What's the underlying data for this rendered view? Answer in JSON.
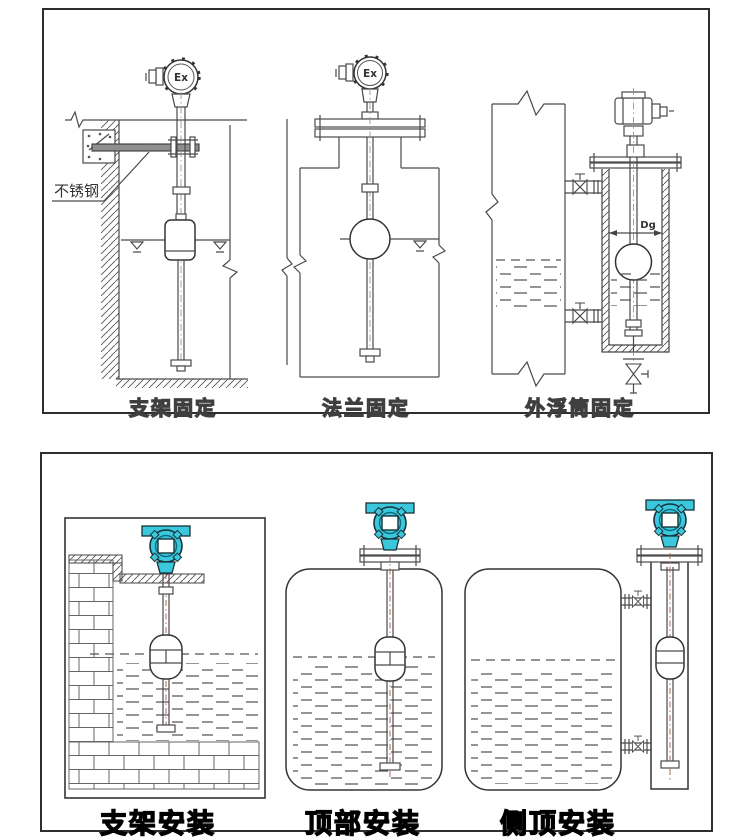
{
  "colors": {
    "transmitter_head_teal": "#3cc8dc",
    "line_art": "#4a4a4a",
    "panel_border": "#2e2e2e"
  },
  "top_panel": {
    "captions": [
      "支架固定",
      "法兰固定",
      "外浮筒固定"
    ],
    "labels": {
      "stainless_steel": "不锈钢",
      "explosion_proof": "Ex",
      "diameter": "Dg"
    }
  },
  "bottom_panel": {
    "captions": [
      "支架安装",
      "顶部安装",
      "侧顶安装"
    ]
  }
}
